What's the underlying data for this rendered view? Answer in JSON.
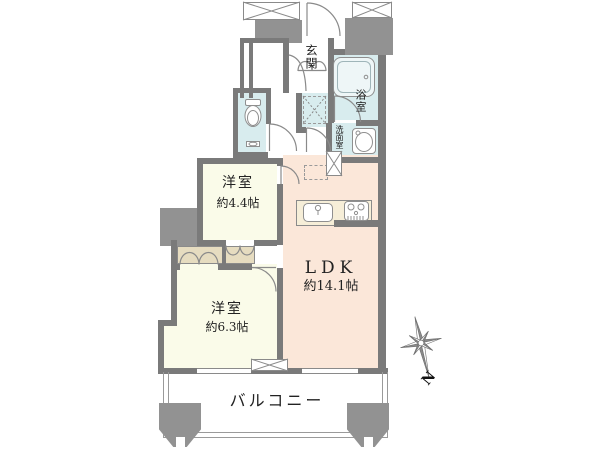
{
  "title": "2LDK floor plan",
  "colors": {
    "wall": "#7a7a7a",
    "block": "#929292",
    "line": "#8a8a8a",
    "ldk": "#fbe7d9",
    "room": "#fafbe9",
    "wet": "#d8ecee",
    "closet": "#e6dcc0",
    "counter": "#f6eed8"
  },
  "rooms": {
    "genkan": {
      "label": "玄関"
    },
    "bath": {
      "label": "浴室"
    },
    "washroom": {
      "label": "洗面室"
    },
    "western_room_1": {
      "label": "洋室",
      "size": "約4.4帖"
    },
    "western_room_2": {
      "label": "洋室",
      "size": "約6.3帖"
    },
    "ldk": {
      "label": "LDK",
      "size": "約14.1帖"
    },
    "balcony": {
      "label": "バルコニー"
    }
  },
  "compass": {
    "north_label": "N"
  }
}
